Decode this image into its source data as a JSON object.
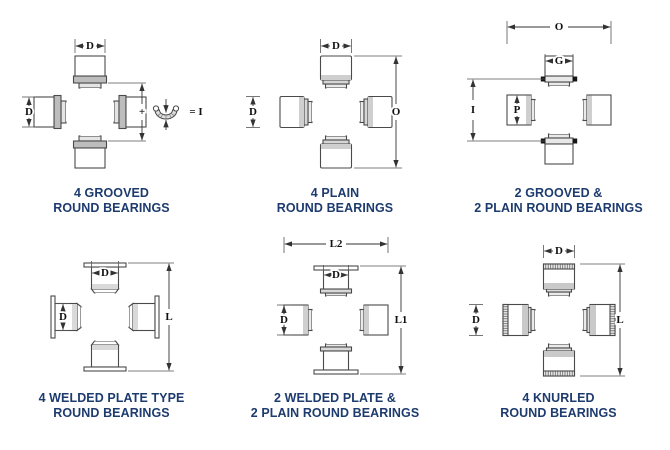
{
  "figure": {
    "title": "universal-joint-bearing-types",
    "colors": {
      "background": "#ffffff",
      "caption_text": "#1d3b6e",
      "drawing_line": "#4a4a4a",
      "dimension_line": "#333333",
      "collar_shade": "#bdbdbd",
      "groove_ring_black": "#161616"
    }
  },
  "panels": [
    {
      "id": "4-grooved-round-bearings",
      "caption_line1": "4 GROOVED",
      "caption_line2": "ROUND BEARINGS",
      "dims": {
        "top": "D",
        "left": "D",
        "plus": "+",
        "equals": "= I"
      },
      "notes": {
        "snap_ring": "c-clip snap ring shown beside joint"
      }
    },
    {
      "id": "4-plain-round-bearings",
      "caption_line1": "4 PLAIN",
      "caption_line2": "ROUND BEARINGS",
      "dims": {
        "top": "D",
        "left": "D",
        "right": "O"
      }
    },
    {
      "id": "2-grooved-2-plain-round-bearings",
      "caption_line1": "2 GROOVED &",
      "caption_line2": "2 PLAIN ROUND BEARINGS",
      "dims": {
        "overall_width": "O",
        "cap": "G",
        "left": "I",
        "cap_left": "P"
      }
    },
    {
      "id": "4-welded-plate-type-round-bearings",
      "caption_line1": "4 WELDED PLATE TYPE",
      "caption_line2": "ROUND BEARINGS",
      "dims": {
        "top": "D",
        "left": "D",
        "right": "L"
      }
    },
    {
      "id": "2-welded-plate-2-plain-round-bearings",
      "caption_line1": "2 WELDED PLATE &",
      "caption_line2": "2 PLAIN ROUND BEARINGS",
      "dims": {
        "overall_width": "L2",
        "top": "D",
        "left": "D",
        "right": "L1"
      }
    },
    {
      "id": "4-knurled-round-bearings",
      "caption_line1": "4 KNURLED",
      "caption_line2": "ROUND BEARINGS",
      "dims": {
        "top": "D",
        "left": "D",
        "right": "L"
      }
    }
  ]
}
